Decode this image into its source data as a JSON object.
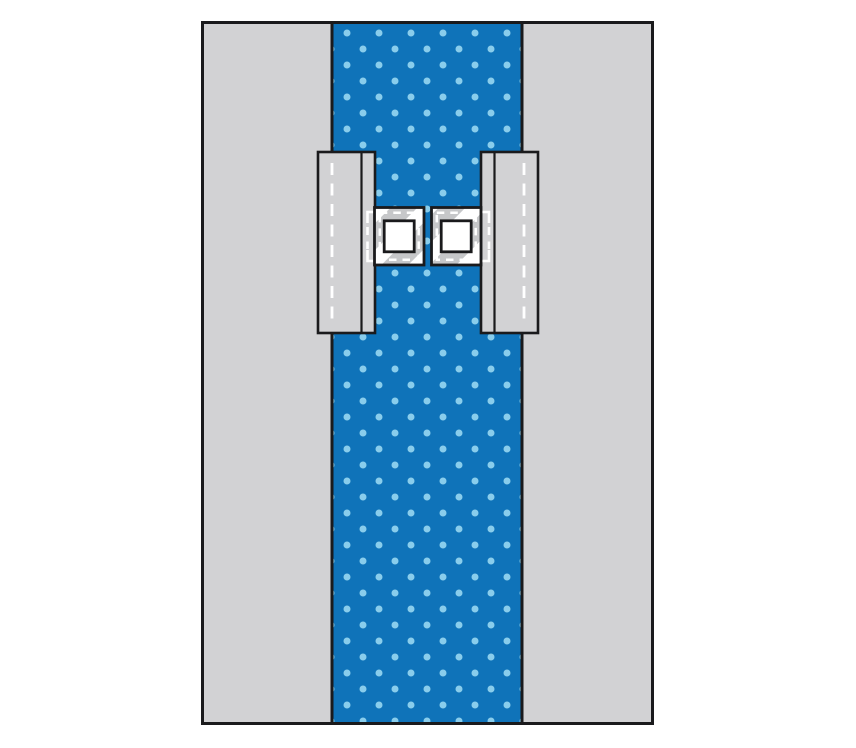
{
  "alt": "Diagram of a surgical drape: grey rectangular drape with a blue polka-dot reinforcement strip down the centre, two lateral flap panels marked with vertical dashed lines, and two square adhesive fenestration pads with white square apertures in the middle",
  "colors": {
    "background": "#ffffff",
    "ink": "#1a1a1c",
    "drape_gray": "#d2d2d4",
    "flap_gray": "#d2d2d4",
    "pad_gray": "#c6c7c9",
    "pad_stripe": "#ffffff",
    "strip_blue": "#0f73b9",
    "dot_blue": "#89cdec",
    "dash_white": "#ffffff",
    "aperture_white": "#ffffff"
  },
  "parts": {
    "drape_body": "drape body",
    "reinforcement_strip": "polka-dot reinforcement strip",
    "left_flap": "left flap panel",
    "right_flap": "right flap panel",
    "fenestration_zone": "dashed fenestration zone",
    "left_pad": "left fenestration pad",
    "right_pad": "right fenestration pad",
    "left_aperture": "left square aperture",
    "right_aperture": "right square aperture"
  }
}
